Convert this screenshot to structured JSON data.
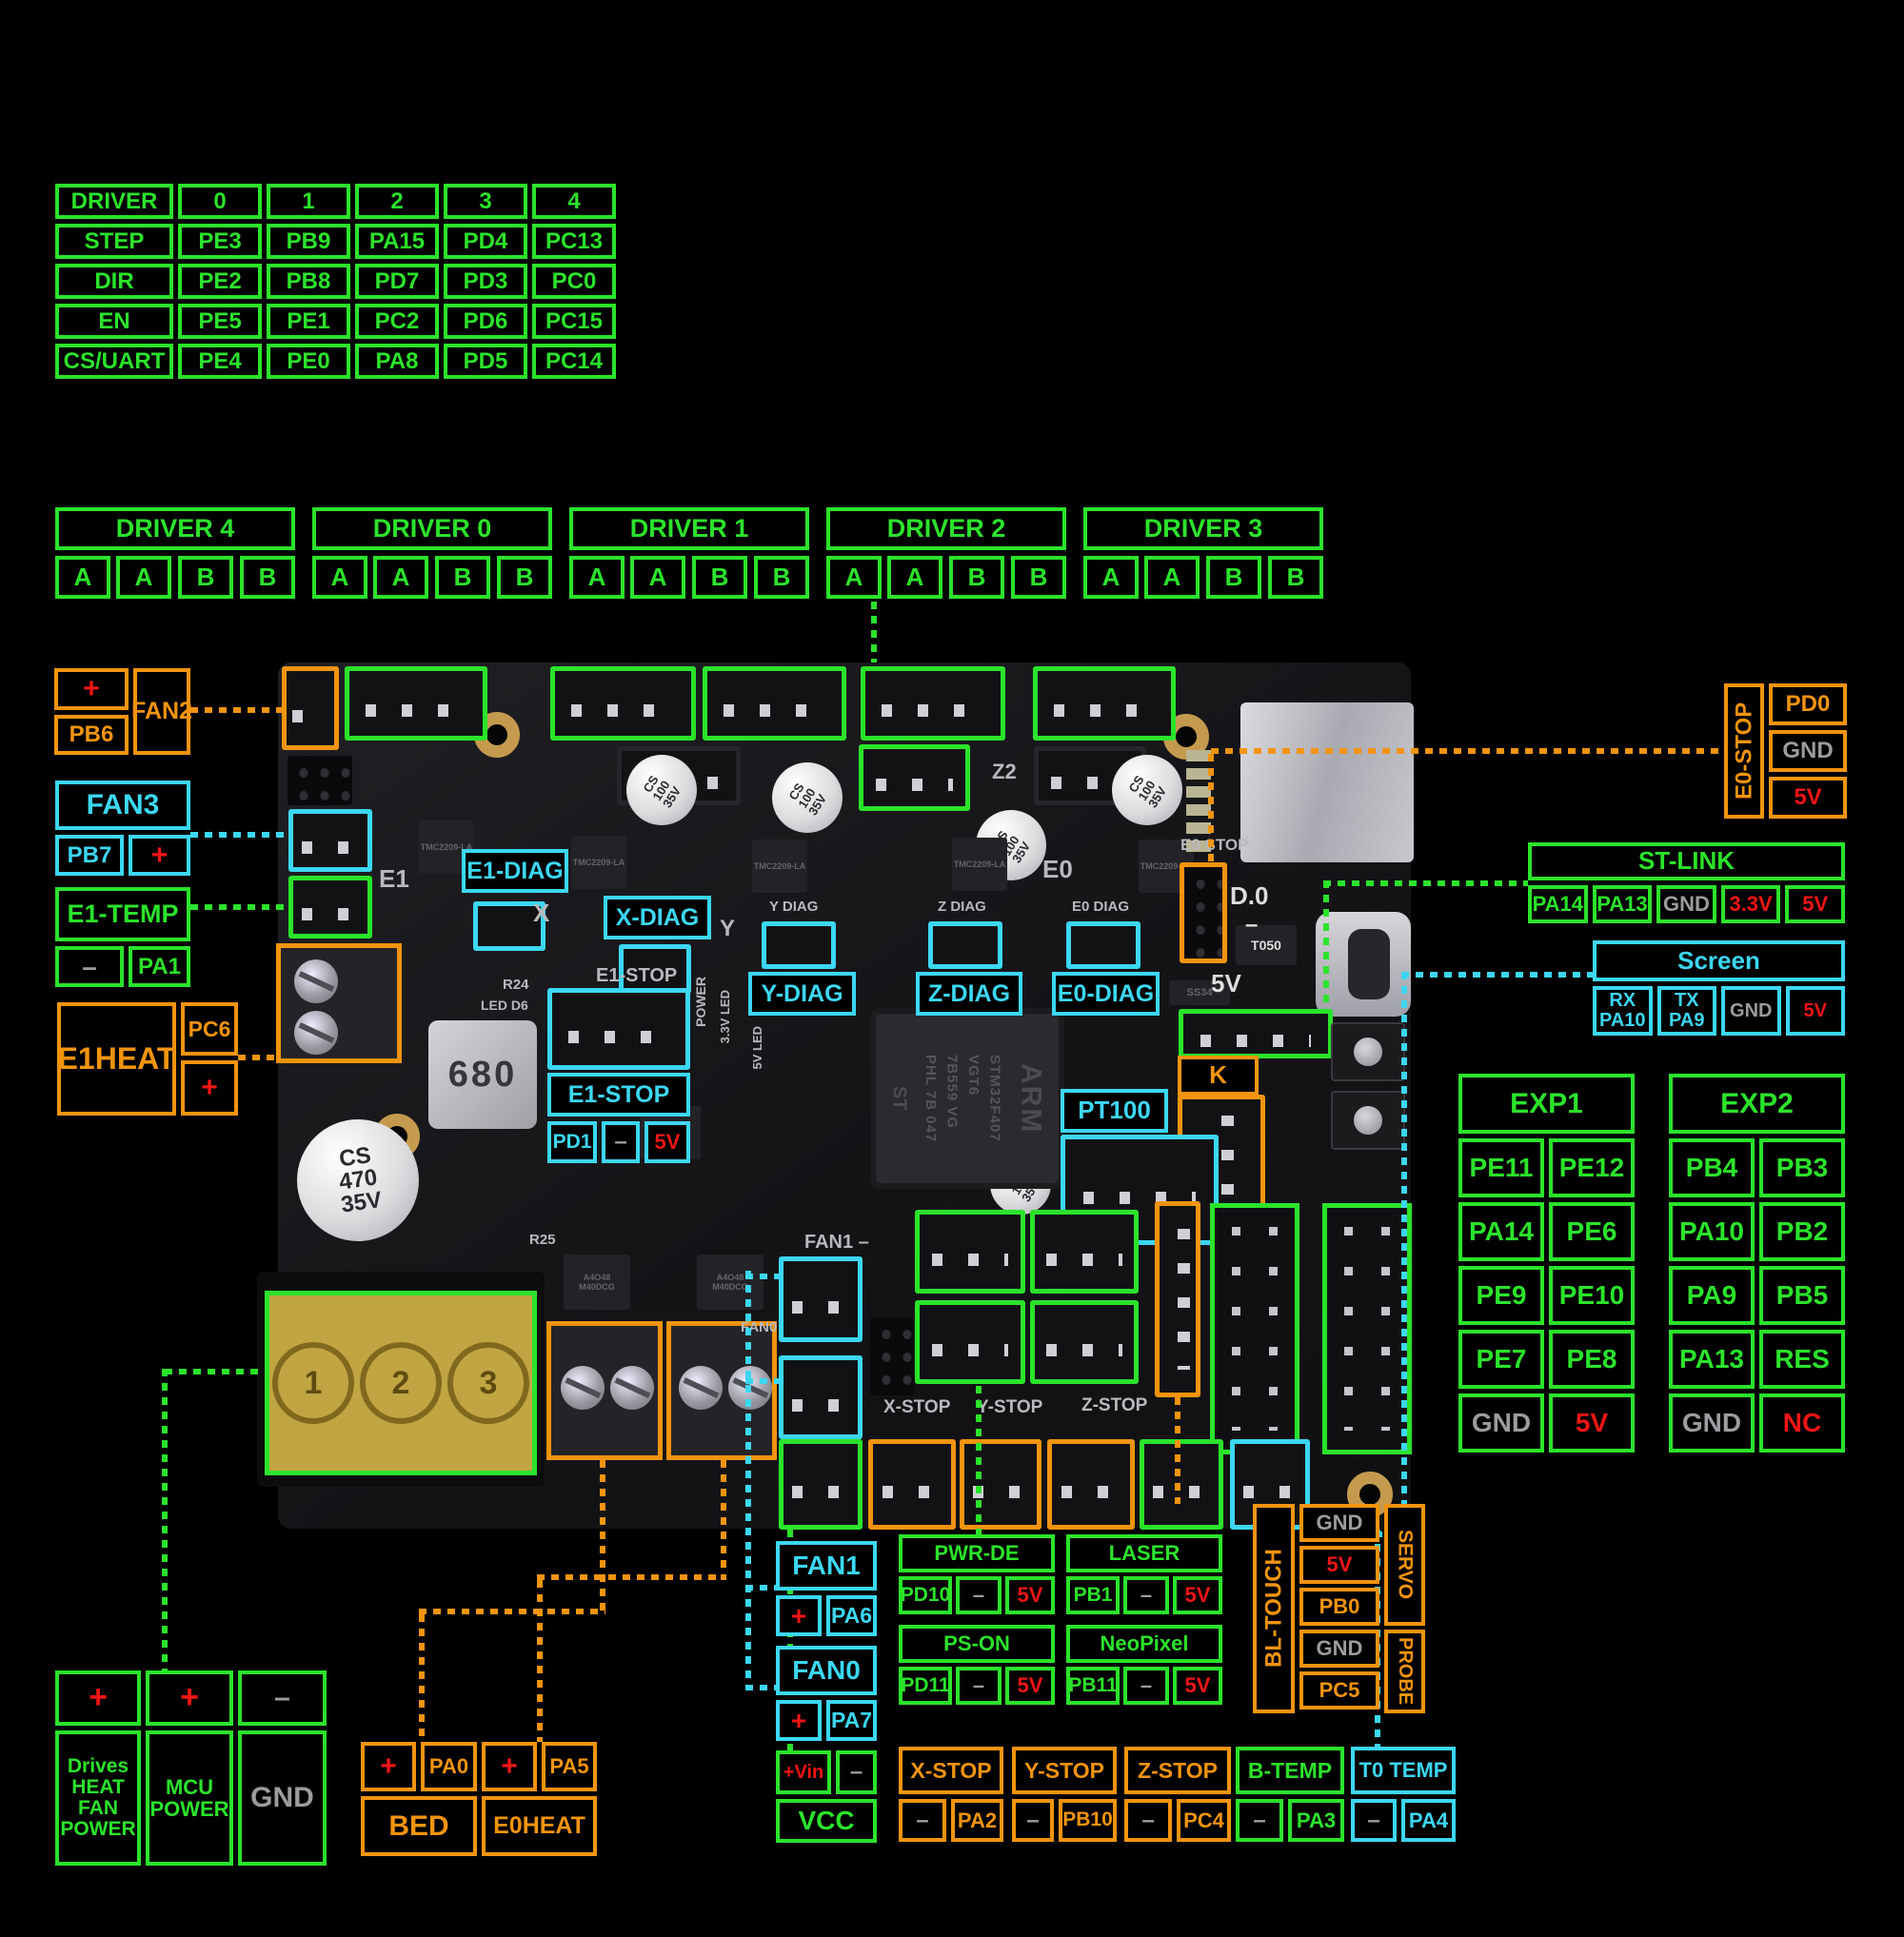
{
  "colors": {
    "green": "#2be32b",
    "cyan": "#3cd7f2",
    "orange": "#f2940e",
    "red": "#f11515",
    "gray": "#9c9ca0"
  },
  "pin_table": {
    "cells": [
      "DRIVER",
      "0",
      "1",
      "2",
      "3",
      "4",
      "STEP",
      "PE3",
      "PB9",
      "PA15",
      "PD4",
      "PC13",
      "DIR",
      "PE2",
      "PB8",
      "PD7",
      "PD3",
      "PC0",
      "EN",
      "PE5",
      "PE1",
      "PC2",
      "PD6",
      "PC15",
      "CS/UART",
      "PE4",
      "PE0",
      "PA8",
      "PD5",
      "PC14"
    ]
  },
  "driver_blocks": [
    {
      "title": "DRIVER 4",
      "p0": "A",
      "p1": "A",
      "p2": "B",
      "p3": "B"
    },
    {
      "title": "DRIVER 0",
      "p0": "A",
      "p1": "A",
      "p2": "B",
      "p3": "B"
    },
    {
      "title": "DRIVER 1",
      "p0": "A",
      "p1": "A",
      "p2": "B",
      "p3": "B"
    },
    {
      "title": "DRIVER 2",
      "p0": "A",
      "p1": "A",
      "p2": "B",
      "p3": "B"
    },
    {
      "title": "DRIVER 3",
      "p0": "A",
      "p1": "A",
      "p2": "B",
      "p3": "B"
    }
  ],
  "fan2": {
    "label": "FAN2",
    "plus": "+",
    "pin": "PB6"
  },
  "fan3": {
    "label": "FAN3",
    "plus": "+",
    "pin": "PB7"
  },
  "e1temp": {
    "label": "E1-TEMP",
    "minus": "–",
    "pin": "PA1"
  },
  "e1heat": {
    "label": "E1HEAT",
    "plus": "+",
    "pin": "PC6"
  },
  "e0stop": {
    "label": "E0-STOP",
    "pin": "PD0",
    "gnd": "GND",
    "v5": "5V"
  },
  "stlink": {
    "title": "ST-LINK",
    "cells": [
      {
        "t": "PA14"
      },
      {
        "t": "PA13"
      },
      {
        "t": "GND",
        "c": "g"
      },
      {
        "t": "3.3V",
        "c": "r"
      },
      {
        "t": "5V",
        "c": "r"
      }
    ]
  },
  "screen": {
    "title": "Screen",
    "cells": [
      {
        "t": "RX\nPA10"
      },
      {
        "t": "TX\nPA9"
      },
      {
        "t": "GND",
        "c": "g"
      },
      {
        "t": "5V",
        "c": "r"
      }
    ]
  },
  "exp1": {
    "title": "EXP1",
    "cells": [
      {
        "t": "PE11"
      },
      {
        "t": "PE12"
      },
      {
        "t": "PA14"
      },
      {
        "t": "PE6"
      },
      {
        "t": "PE9"
      },
      {
        "t": "PE10"
      },
      {
        "t": "PE7"
      },
      {
        "t": "PE8"
      },
      {
        "t": "GND",
        "c": "g"
      },
      {
        "t": "5V",
        "c": "r"
      }
    ]
  },
  "exp2": {
    "title": "EXP2",
    "cells": [
      {
        "t": "PB4"
      },
      {
        "t": "PB3"
      },
      {
        "t": "PA10"
      },
      {
        "t": "PB2"
      },
      {
        "t": "PA9"
      },
      {
        "t": "PB5"
      },
      {
        "t": "PA13"
      },
      {
        "t": "RES"
      },
      {
        "t": "GND",
        "c": "g"
      },
      {
        "t": "NC",
        "c": "r"
      }
    ]
  },
  "diag": {
    "e1": "E1-DIAG",
    "x": "X-DIAG",
    "y": "Y-DIAG",
    "z": "Z-DIAG",
    "e0": "E0-DIAG"
  },
  "e1stop": {
    "title": "E1-STOP",
    "pin": "PD1",
    "minus": "–",
    "v5": "5V"
  },
  "pt100": "PT100",
  "k": "K",
  "fan1": {
    "title": "FAN1",
    "plus": "+",
    "pin": "PA6"
  },
  "fan0": {
    "title": "FAN0",
    "plus": "+",
    "pin": "PA7"
  },
  "vcc": {
    "vin": "+Vin",
    "minus": "–",
    "label": "VCC"
  },
  "pwrde": {
    "title": "PWR-DE",
    "pin": "PD10",
    "minus": "–",
    "v5": "5V"
  },
  "laser": {
    "title": "LASER",
    "pin": "PB1",
    "minus": "–",
    "v5": "5V"
  },
  "pson": {
    "title": "PS-ON",
    "pin": "PD11",
    "minus": "–",
    "v5": "5V"
  },
  "neopixel": {
    "title": "NeoPixel",
    "pin": "PB11",
    "minus": "–",
    "v5": "5V"
  },
  "bltouch": {
    "label": "BL-TOUCH",
    "servo": "SERVO",
    "probe": "PROBE",
    "cells": [
      {
        "t": "GND",
        "c": "g"
      },
      {
        "t": "5V",
        "c": "r"
      },
      {
        "t": "PB0"
      },
      {
        "t": "GND",
        "c": "g"
      },
      {
        "t": "PC5"
      }
    ]
  },
  "xstop": {
    "title": "X-STOP",
    "minus": "–",
    "pin": "PA2"
  },
  "ystop": {
    "title": "Y-STOP",
    "minus": "–",
    "pin": "PB10"
  },
  "zstop": {
    "title": "Z-STOP",
    "minus": "–",
    "pin": "PC4"
  },
  "btemp": {
    "title": "B-TEMP",
    "minus": "–",
    "pin": "PA3"
  },
  "t0temp": {
    "title": "T0 TEMP",
    "minus": "–",
    "pin": "PA4"
  },
  "power": {
    "plus1": "+",
    "plus2": "+",
    "minus": "–",
    "col1": "Drives\nHEAT\nFAN\nPOWER",
    "col2": "MCU\nPOWER",
    "col3": "GND"
  },
  "bed": {
    "plus": "+",
    "pin": "PA0",
    "label": "BED"
  },
  "e0heat": {
    "plus": "+",
    "pin": "PA5",
    "label": "E0HEAT"
  },
  "board": {
    "silkscreen": {
      "e1": "E1",
      "x": "X",
      "y": "Y",
      "z2": "Z2",
      "e0": "E0",
      "ydiag": "Y DIAG",
      "zdiag": "Z DIAG",
      "e0diag": "E0 DIAG",
      "e0stop": "E0 STOP",
      "d0": "D.0",
      "minus": "–",
      "v5": "5V",
      "fan1": "FAN1  –",
      "fan0": "FAN0",
      "xstop": "X-STOP",
      "ystop": "Y-STOP",
      "zstop": "Z-STOP",
      "r24": "R24",
      "led_d6": "LED D6",
      "e1stop": "E1-STOP",
      "power": "POWER",
      "led33": "3.3V LED",
      "led5": "5V LED",
      "r25": "R25",
      "cap100": "CS\n100\n35V",
      "cap470": "CS\n470\n35V",
      "inductor": "680",
      "ams": "AMS1117\n33 C202",
      "t050": "T050",
      "ss34": "SS34",
      "mcu_lines": "STM32F407\nVGT6\n7B559 VG\nPHL 7B 047",
      "arm": "ARM",
      "st": "ST",
      "driver_chip": "TMC2209-LA",
      "mosfet": "A4O48\nM40DCG",
      "term1": "1",
      "term2": "2",
      "term3": "3"
    }
  }
}
